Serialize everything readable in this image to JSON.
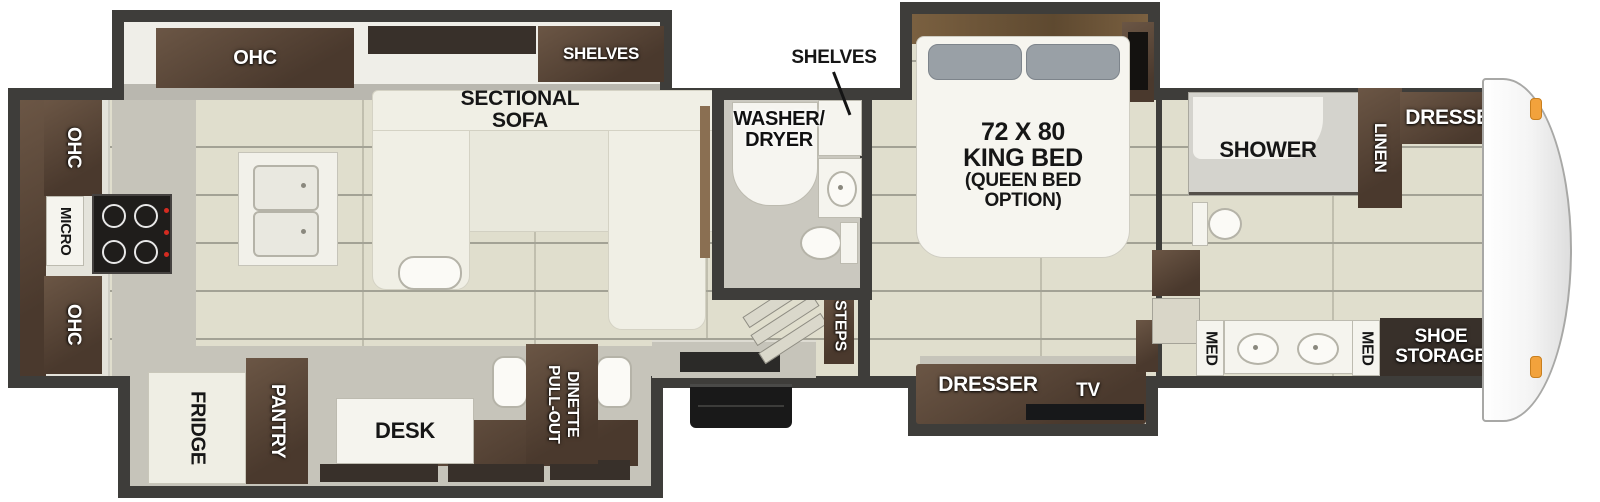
{
  "colors": {
    "wall": "#3e3d3a",
    "floor": "#e0decd",
    "floor_gray": "#c6c4ba",
    "cabinet_dark": "#4a392d",
    "cabinet_light": "#6b5645",
    "marker_orange": "#f2a23c"
  },
  "labels": {
    "kitchen": {
      "ohc_slide": "OHC",
      "ohc_upper": "OHC",
      "micro": "MICRO",
      "ohc_lower": "OHC",
      "fridge": "FRIDGE",
      "pantry": "PANTRY"
    },
    "living": {
      "shelves_slide": "SHELVES",
      "sofa_line1": "SECTIONAL",
      "sofa_line2": "SOFA",
      "desk": "DESK",
      "dinette_line1": "PULL-OUT",
      "dinette_line2": "DINETTE"
    },
    "midbath": {
      "shelves": "SHELVES",
      "washer_line1": "WASHER/",
      "washer_line2": "DRYER"
    },
    "stairs": {
      "steps": "STEPS"
    },
    "bedroom": {
      "bed_line1": "72 X 80",
      "bed_line2": "KING BED",
      "bed_line3": "(QUEEN BED",
      "bed_line4": "OPTION)",
      "dresser": "DRESSER",
      "tv": "TV"
    },
    "frontbath": {
      "shower": "SHOWER",
      "linen": "LINEN",
      "dresser": "DRESSER",
      "med_left": "MED",
      "med_right": "MED",
      "shoe_line1": "SHOE",
      "shoe_line2": "STORAGE"
    }
  }
}
